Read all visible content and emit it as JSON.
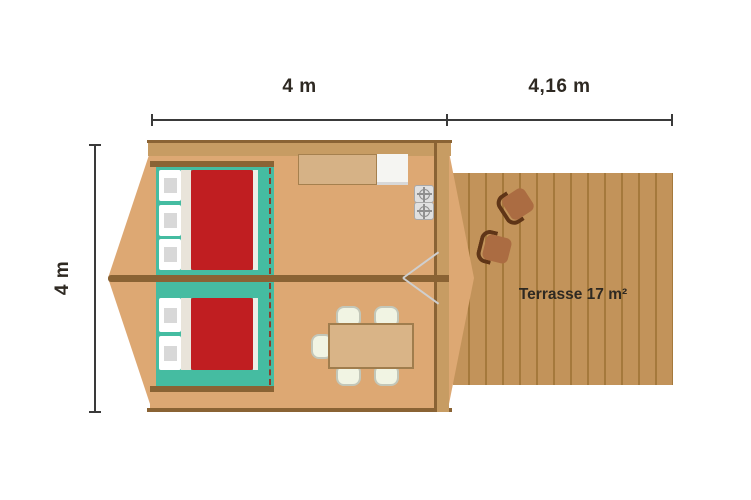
{
  "labels": {
    "cabin_width": "4 m",
    "terrace_width": "4,16 m",
    "cabin_height": "4 m",
    "terrace": "Terrasse 17 m²"
  },
  "icons": {
    "stove_burner": "gas-burner-crosshair-ring"
  },
  "colors": {
    "floor": "#DDA873",
    "wall-dark": "#8A6334",
    "wall-light": "#C79C63",
    "bedroom-teal": "#45BCA1",
    "bed-red": "#C01E21",
    "terrace-tan": "#C2935A",
    "plank-line": "#A5793C",
    "chair-brown": "#AB6C42",
    "chair-back": "#5F3517",
    "dim": "#3A3A3A",
    "text": "#2E2922"
  }
}
